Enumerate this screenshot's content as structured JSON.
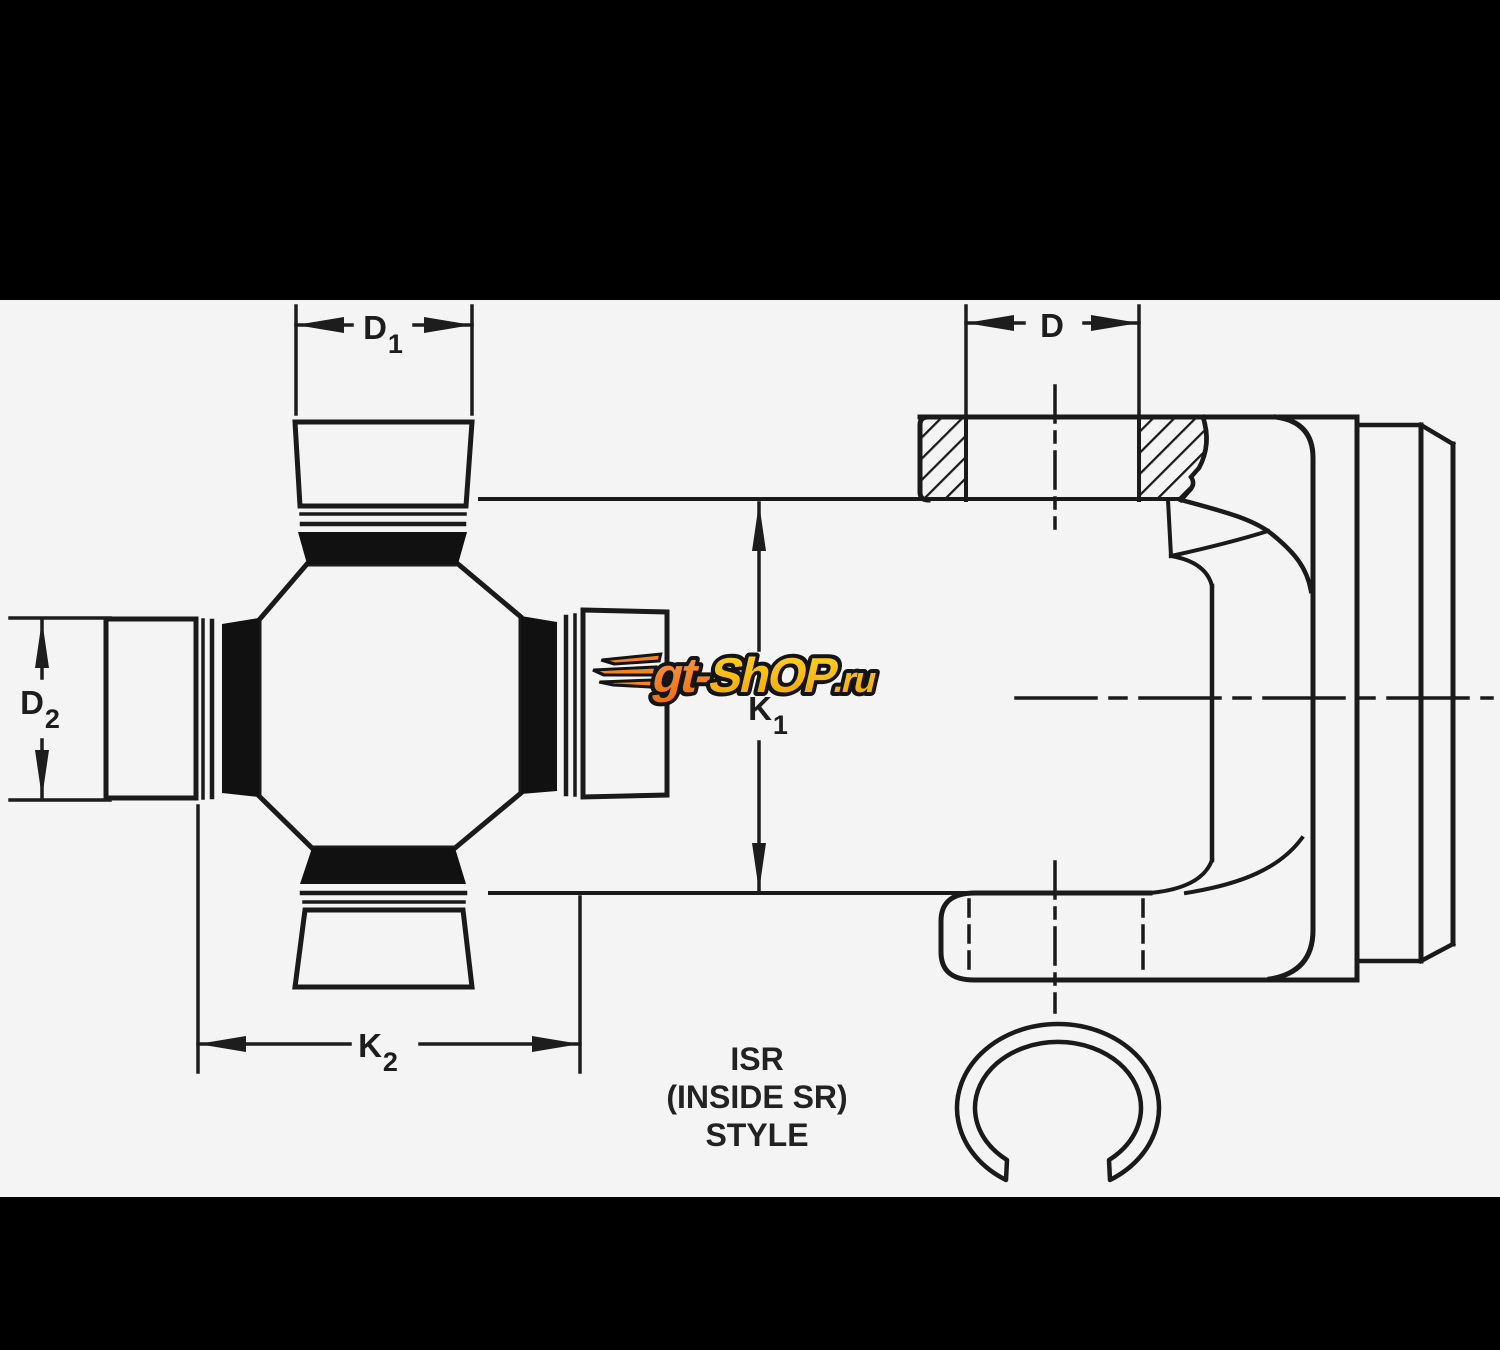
{
  "diagram": {
    "type": "technical-drawing",
    "subject": "Universal joint cross and inside-snap-ring yoke dimensional diagram"
  },
  "letterbox": {
    "bar_color": "#000000",
    "top_bar_height": 300,
    "bottom_bar_height": 153
  },
  "canvas": {
    "background": "#f4f4f4",
    "line_color": "#1a1a1a",
    "seal_color": "#111111"
  },
  "dimensions": {
    "d1": {
      "base": "D",
      "sub": "1"
    },
    "d2": {
      "base": "D",
      "sub": "2"
    },
    "d": {
      "base": "D",
      "sub": ""
    },
    "k1": {
      "base": "K",
      "sub": "1"
    },
    "k2": {
      "base": "K",
      "sub": "2"
    }
  },
  "caption": {
    "line1": "ISR",
    "line2": "(INSIDE SR)",
    "line3": "STYLE"
  },
  "watermark": {
    "part1": "gt-",
    "part2": "ShOP",
    "part3": ".ru",
    "orange": "#F5831F",
    "yellow": "#FFC50D"
  }
}
